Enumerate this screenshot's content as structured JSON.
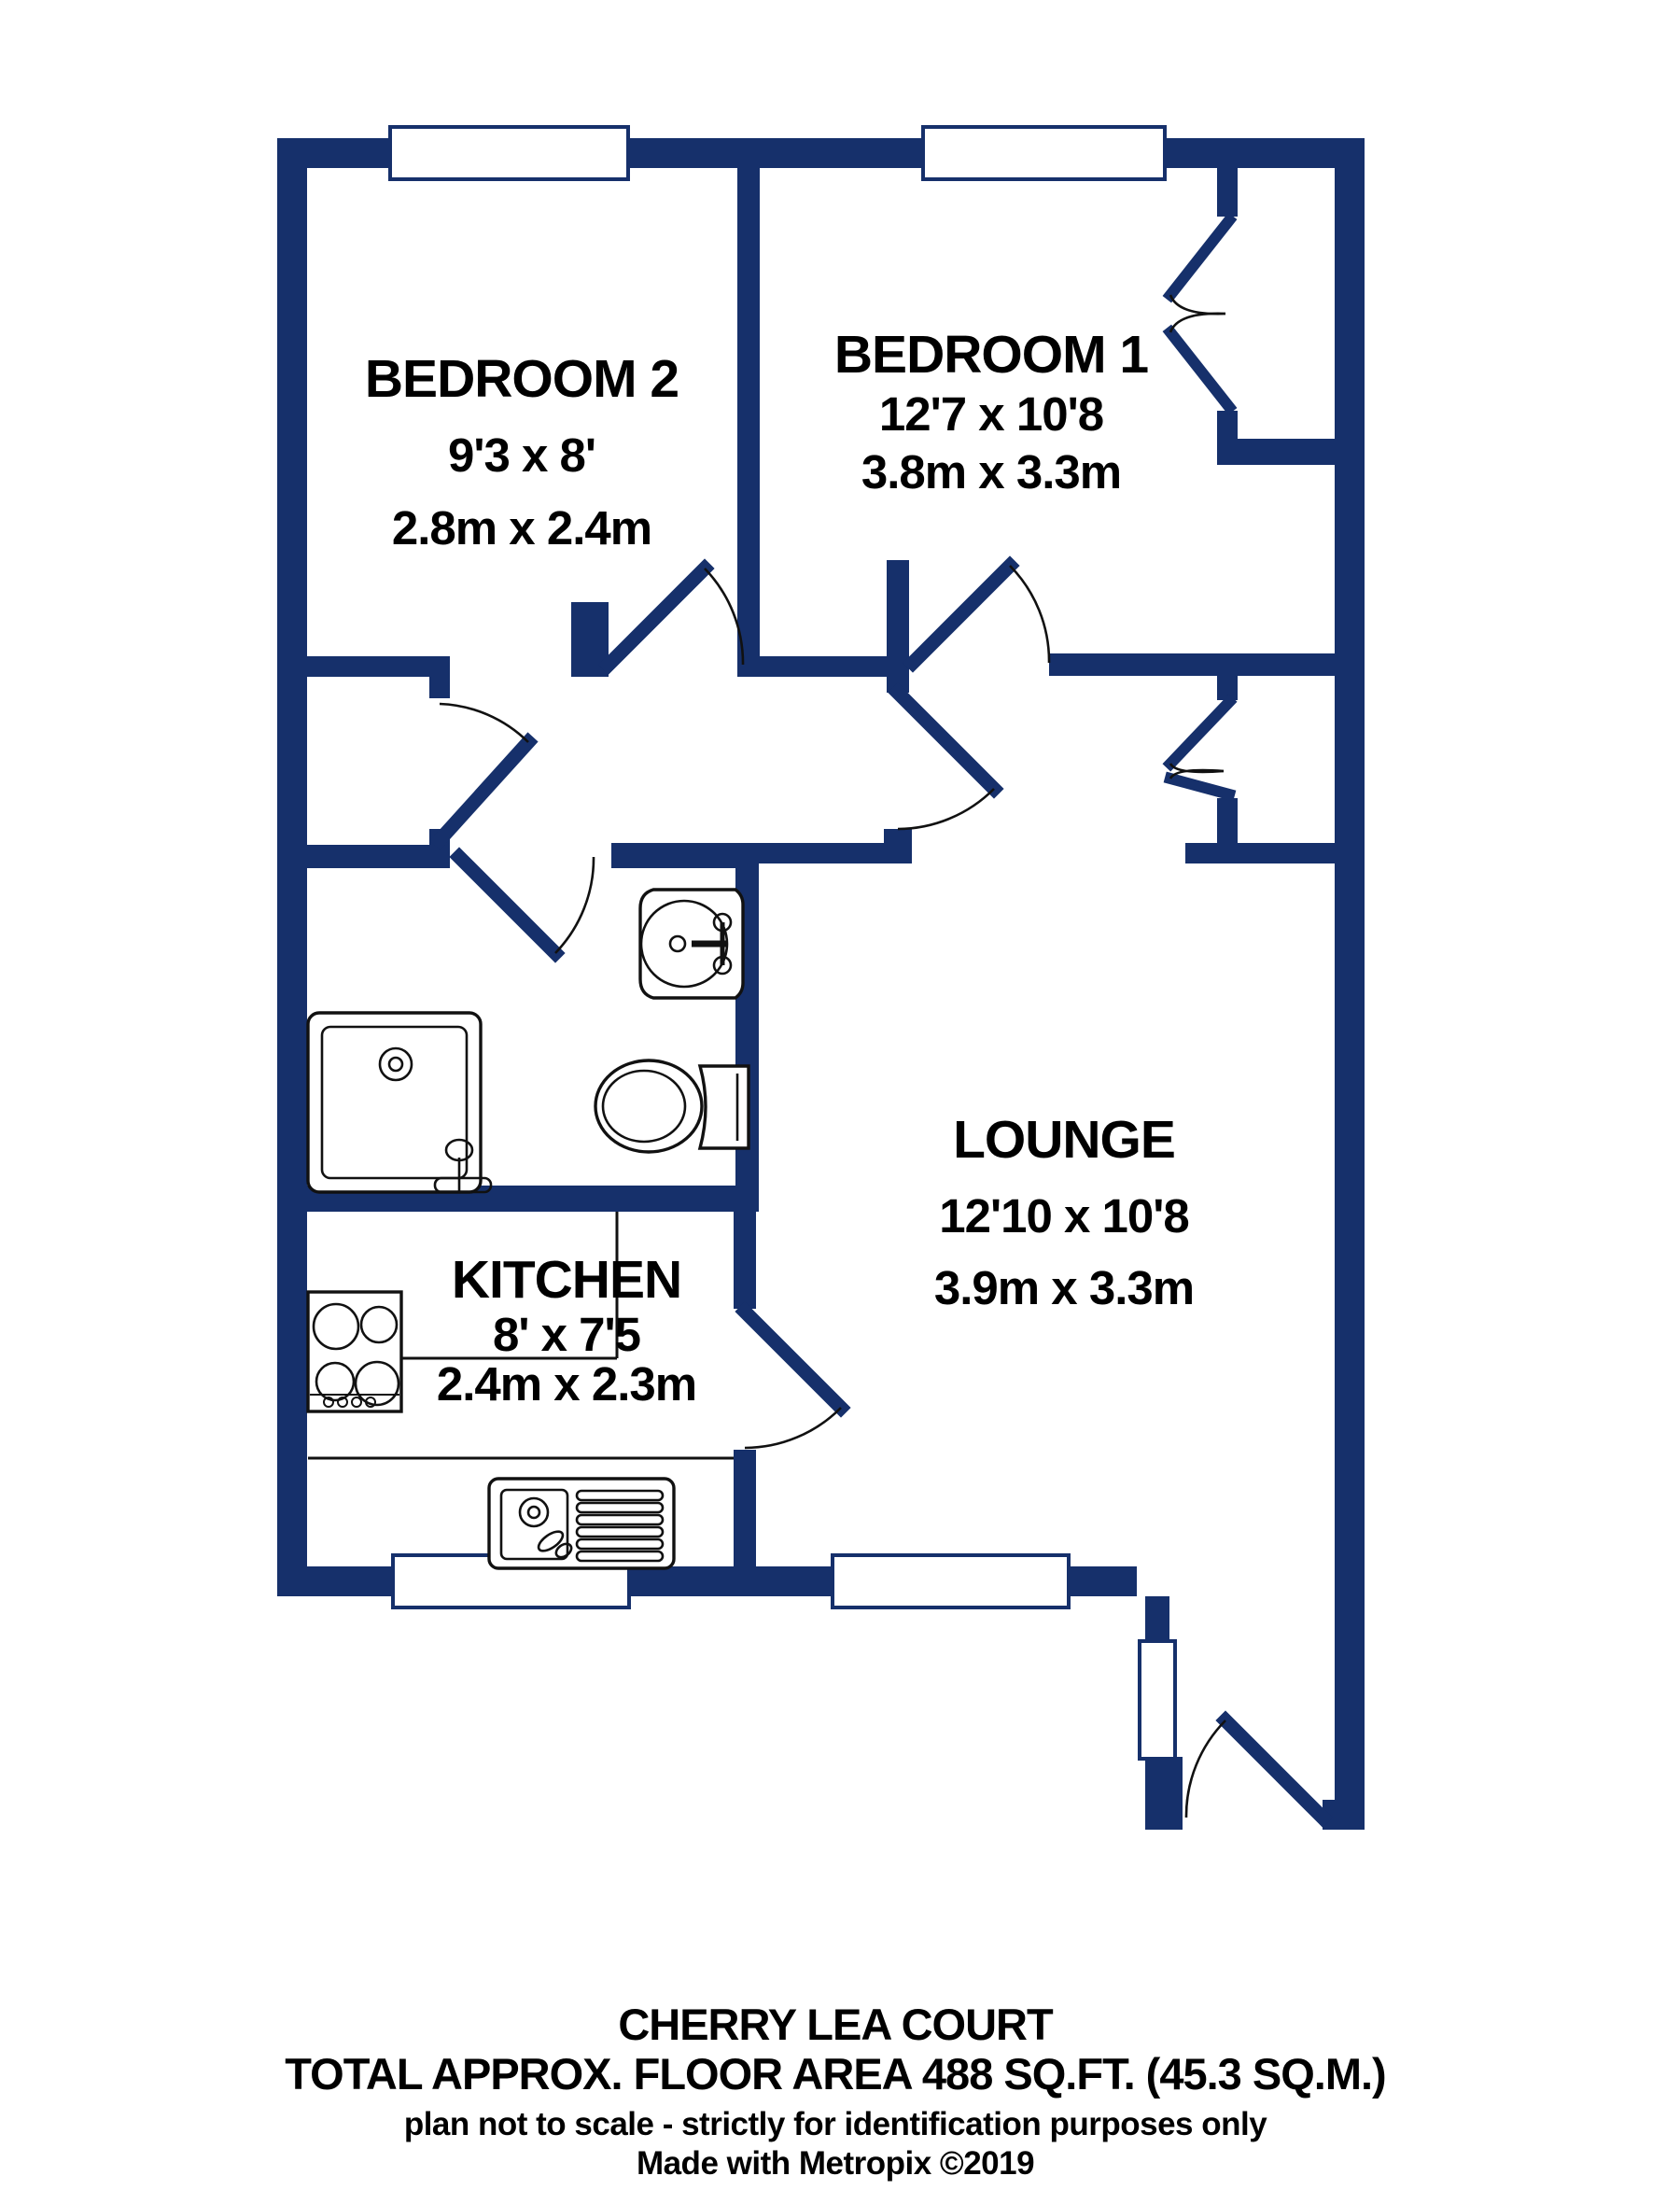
{
  "title": "Floor plan",
  "colors": {
    "wall": "#16306b",
    "line": "#111111",
    "bg": "#ffffff"
  },
  "rooms": {
    "bedroom2": {
      "name": "BEDROOM 2",
      "imperial": "9'3 x 8'",
      "metric": "2.8m x 2.4m"
    },
    "bedroom1": {
      "name": "BEDROOM 1",
      "imperial": "12'7 x 10'8",
      "metric": "3.8m x 3.3m"
    },
    "lounge": {
      "name": "LOUNGE",
      "imperial": "12'10 x 10'8",
      "metric": "3.9m x 3.3m"
    },
    "kitchen": {
      "name": "KITCHEN",
      "imperial": "8' x 7'5",
      "metric": "2.4m x 2.3m"
    }
  },
  "footer": {
    "property_name": "CHERRY LEA COURT",
    "area_line": "TOTAL APPROX. FLOOR AREA 488 SQ.FT. (45.3 SQ.M.)",
    "disclaimer": "plan not to scale - strictly for identification purposes only",
    "credit": "Made with Metropix ©2019"
  }
}
